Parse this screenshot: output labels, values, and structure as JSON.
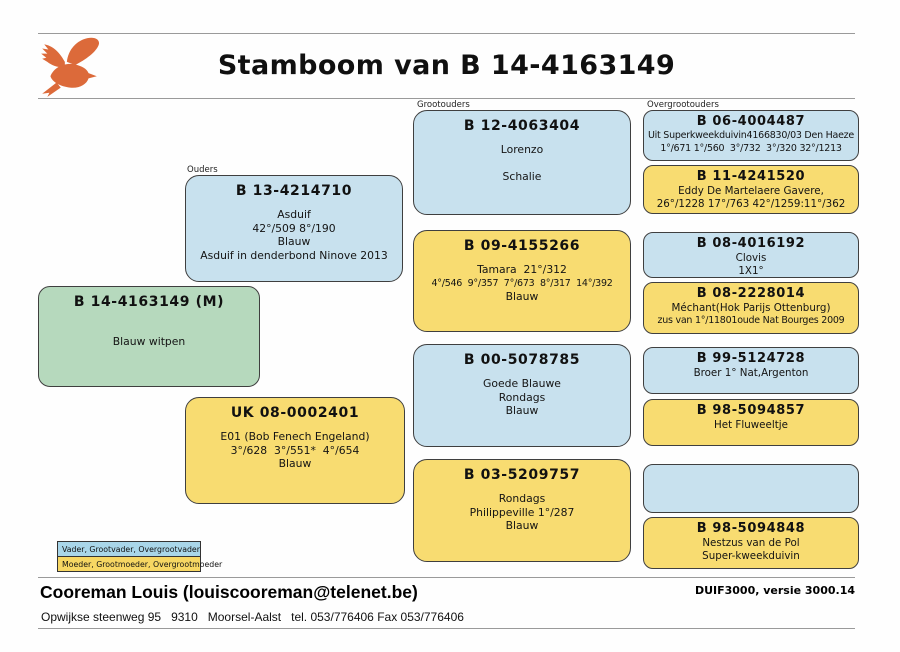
{
  "page": {
    "title": "Stamboom van B 14-4163149"
  },
  "section_labels": {
    "ouders": "Ouders",
    "grootouders": "Grootouders",
    "overgrootouders": "Overgrootouders"
  },
  "subject": {
    "title": "B 14-4163149 (M)",
    "lines": [
      "",
      "Blauw witpen"
    ]
  },
  "boxes": [
    {
      "role": "father",
      "color": "blue",
      "title": "B 13-4214710",
      "lines": [
        "Asduif",
        "42°/509 8°/190",
        "Blauw",
        "Asduif in denderbond Ninove 2013"
      ]
    },
    {
      "role": "mother",
      "color": "yellow",
      "title": "UK 08-0002401",
      "lines": [
        "E01 (Bob Fenech Engeland)",
        "3°/628  3°/551*  4°/654",
        "Blauw"
      ]
    },
    {
      "role": "grandfather-paternal",
      "color": "blue",
      "title": "B 12-4063404",
      "lines": [
        "Lorenzo",
        "",
        "Schalie"
      ]
    },
    {
      "role": "grandmother-paternal",
      "color": "yellow",
      "title": "B 09-4155266",
      "lines": [
        "Tamara  21°/312",
        "4°/546  9°/357  7°/673  8°/317  14°/392",
        "Blauw"
      ]
    },
    {
      "role": "grandfather-maternal",
      "color": "blue",
      "title": "B 00-5078785",
      "lines": [
        "Goede Blauwe",
        "Rondags",
        "Blauw"
      ]
    },
    {
      "role": "grandmother-maternal",
      "color": "yellow",
      "title": "B 03-5209757",
      "lines": [
        "Rondags",
        "Philippeville 1°/287",
        "Blauw"
      ]
    },
    {
      "role": "great-grandfather-1",
      "color": "blue",
      "title": "B 06-4004487",
      "lines": [
        "Uit Superkweekduivin4166830/03 Den Haeze",
        "1°/671 1°/560  3°/732  3°/320 32°/1213"
      ]
    },
    {
      "role": "great-grandmother-1",
      "color": "yellow",
      "title": "B 11-4241520",
      "lines": [
        "Eddy De Martelaere Gavere,",
        "26°/1228 17°/763 42°/1259:11°/362"
      ]
    },
    {
      "role": "great-grandfather-2",
      "color": "blue",
      "title": "B 08-4016192",
      "lines": [
        "Clovis",
        "1X1°"
      ]
    },
    {
      "role": "great-grandmother-2",
      "color": "yellow",
      "title": "B 08-2228014",
      "lines": [
        "Méchant(Hok Parijs Ottenburg)",
        "zus van 1°/11801oude Nat Bourges 2009"
      ]
    },
    {
      "role": "great-grandfather-3",
      "color": "blue",
      "title": "B 99-5124728",
      "lines": [
        "Broer 1° Nat,Argenton"
      ]
    },
    {
      "role": "great-grandmother-3",
      "color": "yellow",
      "title": "B 98-5094857",
      "lines": [
        "Het Fluweeltje"
      ]
    },
    {
      "role": "great-grandfather-4",
      "color": "blue",
      "title": "",
      "lines": [
        "",
        ""
      ]
    },
    {
      "role": "great-grandmother-4",
      "color": "yellow",
      "title": "B 98-5094848",
      "lines": [
        "Nestzus van de Pol",
        "Super-kweekduivin"
      ]
    }
  ],
  "legend": {
    "male_row": "Vader, Grootvader, Overgrootvader",
    "female_row": "Moeder, Grootmoeder, Overgrootmoeder"
  },
  "footer": {
    "owner": "Cooreman Louis (louiscooreman@telenet.be)",
    "address": "Opwijkse steenweg 95   9310   Moorsel-Aalst   tel. 053/776406 Fax 053/776406",
    "software_version": "DUIF3000, versie 3000.14"
  },
  "icons": {
    "logo": "flying-pigeon"
  },
  "colors": {
    "male-blue": "#c8e1ee",
    "female-yellow": "#f8dc71",
    "subject-green": "#b6d9bd",
    "legend-blue": "#a9d6e9",
    "legend-yellow": "#f7d763",
    "logo-orange": "#dc6a3a",
    "box-border": "#3f3f3f",
    "rule-gray": "#9a9a9a"
  }
}
